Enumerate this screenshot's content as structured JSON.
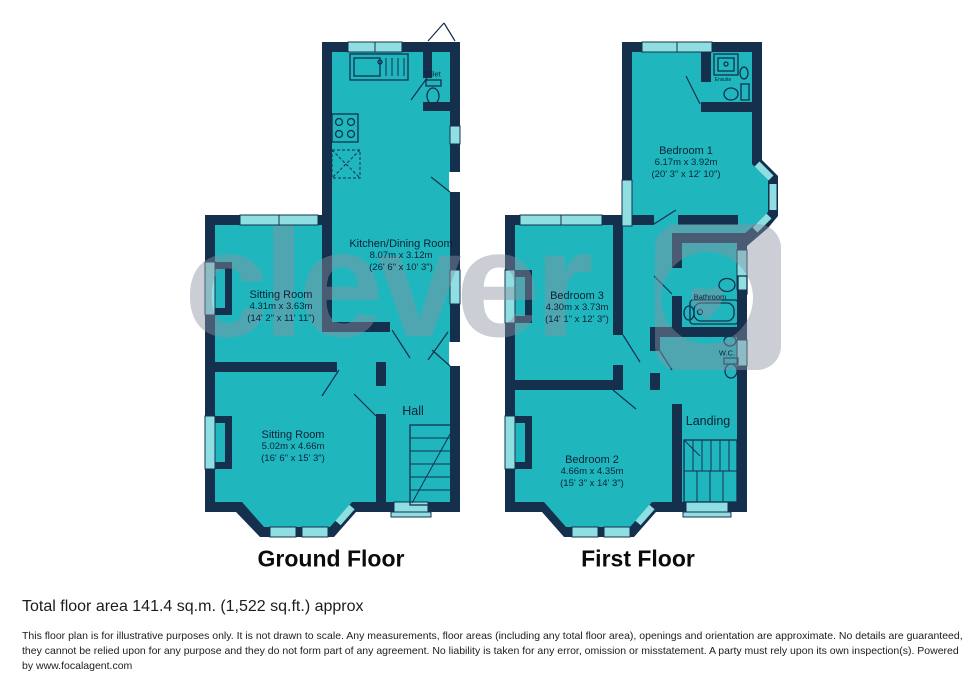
{
  "watermark": {
    "text": "clever"
  },
  "colors": {
    "room_fill": "#1fb7bd",
    "wall": "#14304d",
    "window": "#8fdfe2",
    "watermark_gray": "#8d93a1",
    "label_text": "#0c2236"
  },
  "floors": {
    "ground": {
      "title": "Ground Floor",
      "rooms": {
        "kitchen": {
          "name": "Kitchen/Dining Room",
          "metric": "8.07m x 3.12m",
          "imperial": "(26' 6\" x 10' 3\")"
        },
        "toilet": {
          "name": "Toilet"
        },
        "sitting1": {
          "name": "Sitting Room",
          "metric": "4.31m x 3.63m",
          "imperial": "(14' 2\" x 11' 11\")"
        },
        "sitting2": {
          "name": "Sitting Room",
          "metric": "5.02m x 4.66m",
          "imperial": "(16' 6\" x 15' 3\")"
        },
        "hall": {
          "name": "Hall"
        }
      }
    },
    "first": {
      "title": "First Floor",
      "rooms": {
        "bedroom1": {
          "name": "Bedroom 1",
          "metric": "6.17m x 3.92m",
          "imperial": "(20' 3\" x 12' 10\")"
        },
        "ensuite": {
          "name": "Ensuite"
        },
        "bedroom3": {
          "name": "Bedroom 3",
          "metric": "4.30m x 3.73m",
          "imperial": "(14' 1\" x 12' 3\")"
        },
        "bathroom": {
          "name": "Bathroom"
        },
        "wc": {
          "name": "W.C."
        },
        "bedroom2": {
          "name": "Bedroom 2",
          "metric": "4.66m x 4.35m",
          "imperial": "(15' 3\" x 14' 3\")"
        },
        "landing": {
          "name": "Landing"
        }
      }
    }
  },
  "footer": {
    "total_area": "Total floor area 141.4 sq.m. (1,522 sq.ft.) approx",
    "disclaimer": "This floor plan is for illustrative purposes only. It is not drawn to scale. Any measurements, floor areas (including any total floor area), openings and orientation are approximate. No details are guaranteed, they cannot be relied upon for any purpose and they do not form part of any agreement. No liability is taken for any error, omission or misstatement. A party must rely upon its own inspection(s). Powered by www.focalagent.com"
  }
}
